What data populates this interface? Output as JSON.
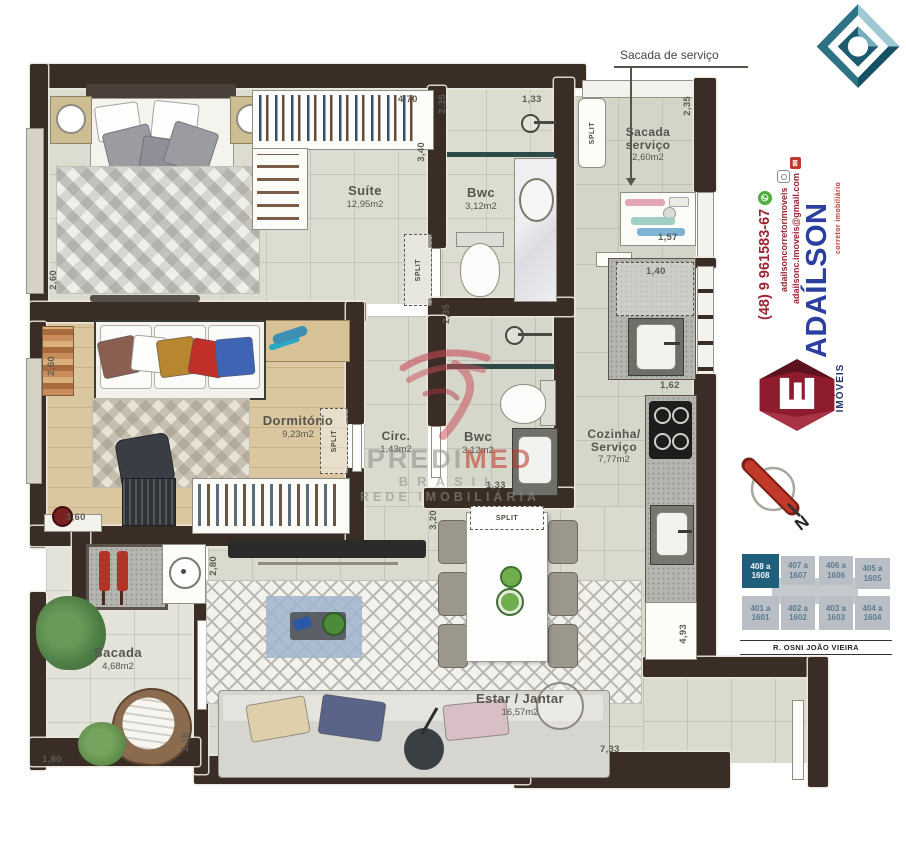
{
  "callout": {
    "text": "Sacada de serviço"
  },
  "labels": {
    "split": "SPLIT"
  },
  "rooms": {
    "suite": {
      "name": "Suíte",
      "area": "12,95m2"
    },
    "bwc1": {
      "name": "Bwc",
      "area": "3,12m2"
    },
    "sacada_servico": {
      "name_line1": "Sacada",
      "name_line2": "serviço",
      "area": "2,60m2"
    },
    "dormitorio": {
      "name": "Dormitório",
      "area": "9,23m2"
    },
    "circ": {
      "name": "Circ.",
      "area": "1,43m2"
    },
    "bwc2": {
      "name": "Bwc",
      "area": "3,12m2"
    },
    "cozinha": {
      "name_line1": "Cozinha/",
      "name_line2": "Serviço",
      "area": "7,77m2"
    },
    "sacada": {
      "name": "Sacada",
      "area": "4,68m2"
    },
    "estar": {
      "name": "Estar / Jantar",
      "area": "16,57m2"
    }
  },
  "dims": {
    "suite_left": "2,60",
    "closet_top": "4,70",
    "suite_right": "3,40",
    "bwc1_left": "2,35",
    "bwc1_top": "1,33",
    "sacada_servico_right": "2,35",
    "laundry_shelf": "1,57",
    "wash_box": "1,40",
    "counter": "1,62",
    "dorm_left": "2,60",
    "dorm_bottom": "3,60",
    "bwc2_left": "2,35",
    "bwc2_bottom": "1,33",
    "living_left": "3,20",
    "living_wall": "2,80",
    "sacada_right": "2,18",
    "sacada_bottom": "1,80",
    "kitchen_right": "4,93",
    "living_bottom": "7,33"
  },
  "watermark": {
    "brand_gray": "PREDI",
    "brand_red": "MED",
    "line2": "BRASIL",
    "line3": "REDE IMOBILIÁRIA"
  },
  "sidebar": {
    "phone": "(48) 9 961583-67",
    "instagram": "adailsoncorretorimoveis",
    "email": "adailsonc.imoveis@gmail.com",
    "brand": "ADAÍLSON",
    "brand_sub": "corretor imobiliário",
    "brand_imoveis": "IMÓVEIS",
    "compass_n": "N",
    "street": "R. OSNI JOÃO VIEIRA",
    "units": [
      {
        "line1": "408 a",
        "line2": "1608"
      },
      {
        "line1": "407 a",
        "line2": "1607"
      },
      {
        "line1": "406 a",
        "line2": "1606"
      },
      {
        "line1": "405 a",
        "line2": "1605"
      },
      {
        "line1": "401 a",
        "line2": "1601"
      },
      {
        "line1": "402 a",
        "line2": "1602"
      },
      {
        "line1": "403 a",
        "line2": "1603"
      },
      {
        "line1": "404 a",
        "line2": "1604"
      }
    ]
  },
  "colors": {
    "wall": "#3a2d25",
    "adailson_blue": "#2b3f9e",
    "contact_red": "#9c2433",
    "logo_maroon": "#8e1c2e",
    "diamond_teal": "#2a6b7e",
    "unit_highlight": "#1f5f7b",
    "predimed_red": "#c0392b"
  }
}
